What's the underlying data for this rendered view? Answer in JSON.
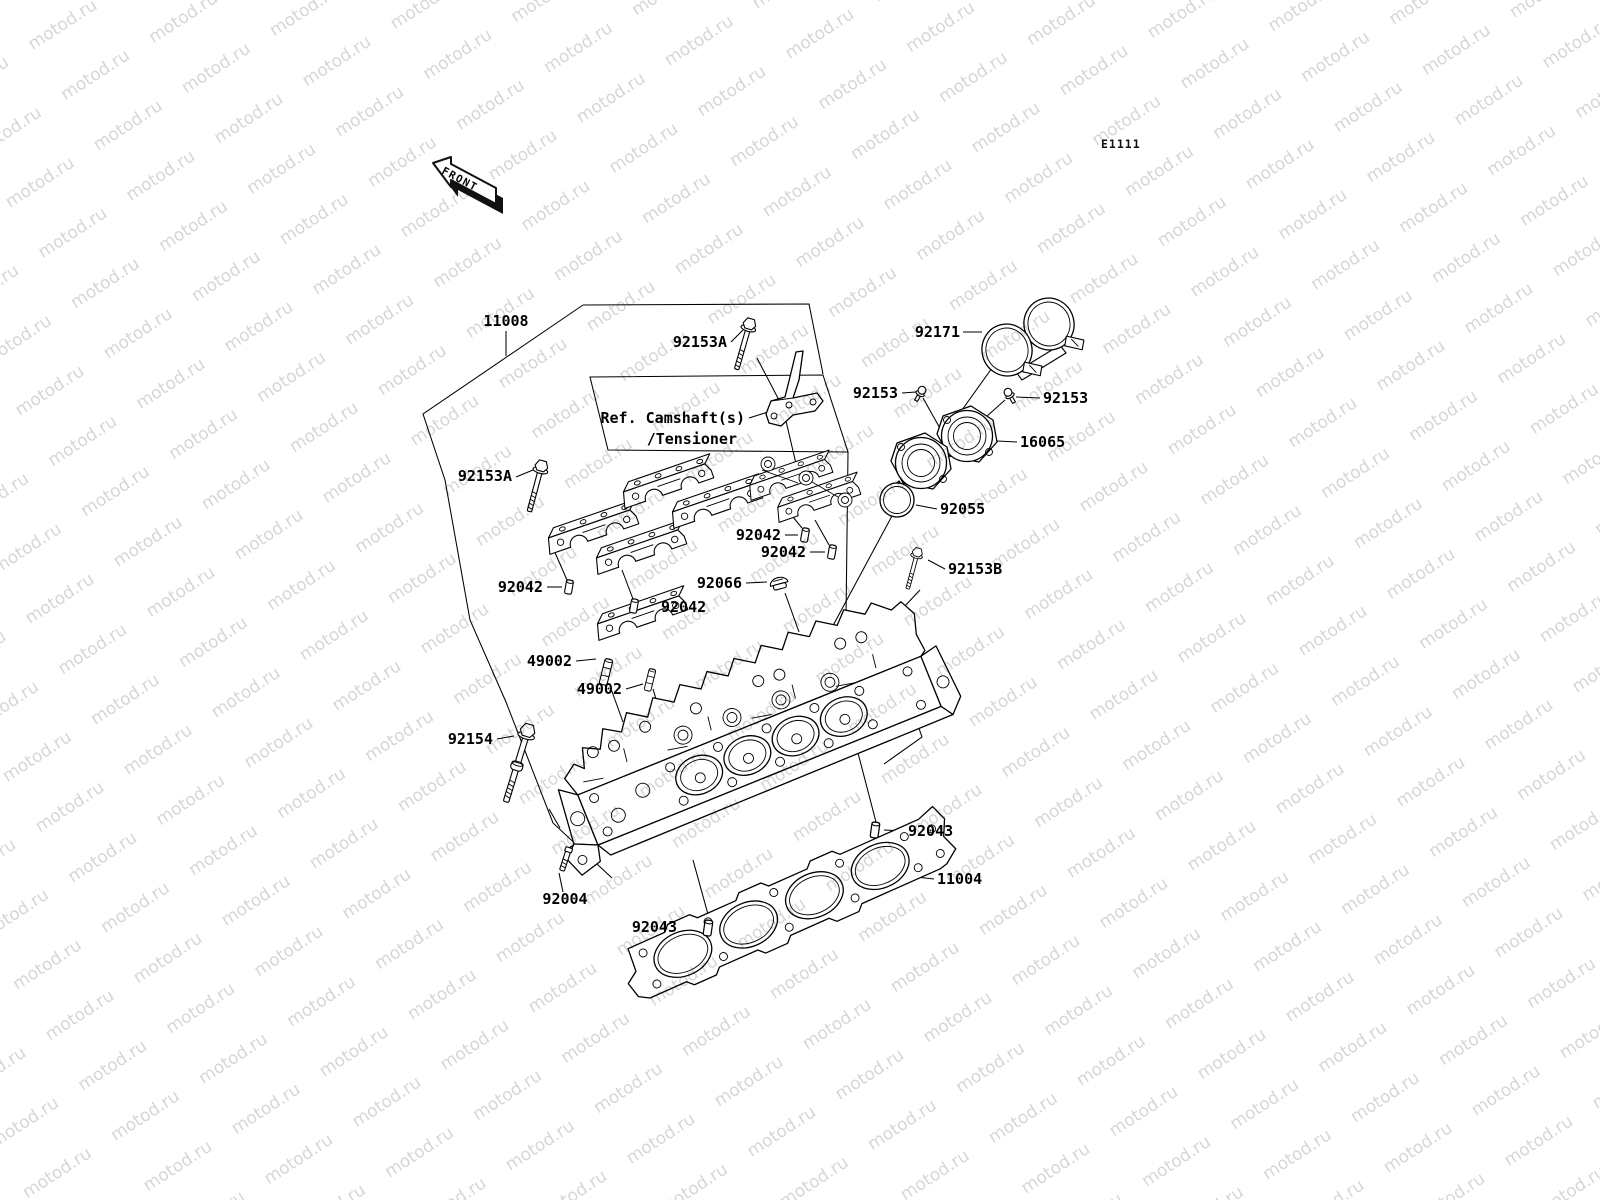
{
  "page": {
    "code": "E1111"
  },
  "watermark": {
    "text": "motod.ru",
    "color": "#d6d6d6"
  },
  "front_marker": {
    "label": "FRONT"
  },
  "ref_note": {
    "line1": "Ref. Camshaft(s)",
    "line2": "/Tensioner"
  },
  "callouts": {
    "c11008": "11008",
    "c92153a_top": "92153A",
    "c92153a_left": "92153A",
    "c92171": "92171",
    "c92153_l": "92153",
    "c92153_r": "92153",
    "c16065": "16065",
    "c92055": "92055",
    "c92153b": "92153B",
    "c92042_l": "92042",
    "c92042_b": "92042",
    "c92042_r1": "92042",
    "c92042_r2": "92042",
    "c92066": "92066",
    "c49002_1": "49002",
    "c49002_2": "49002",
    "c92154": "92154",
    "c92004": "92004",
    "c92043_b": "92043",
    "c92043_r": "92043",
    "c11004": "11004"
  }
}
